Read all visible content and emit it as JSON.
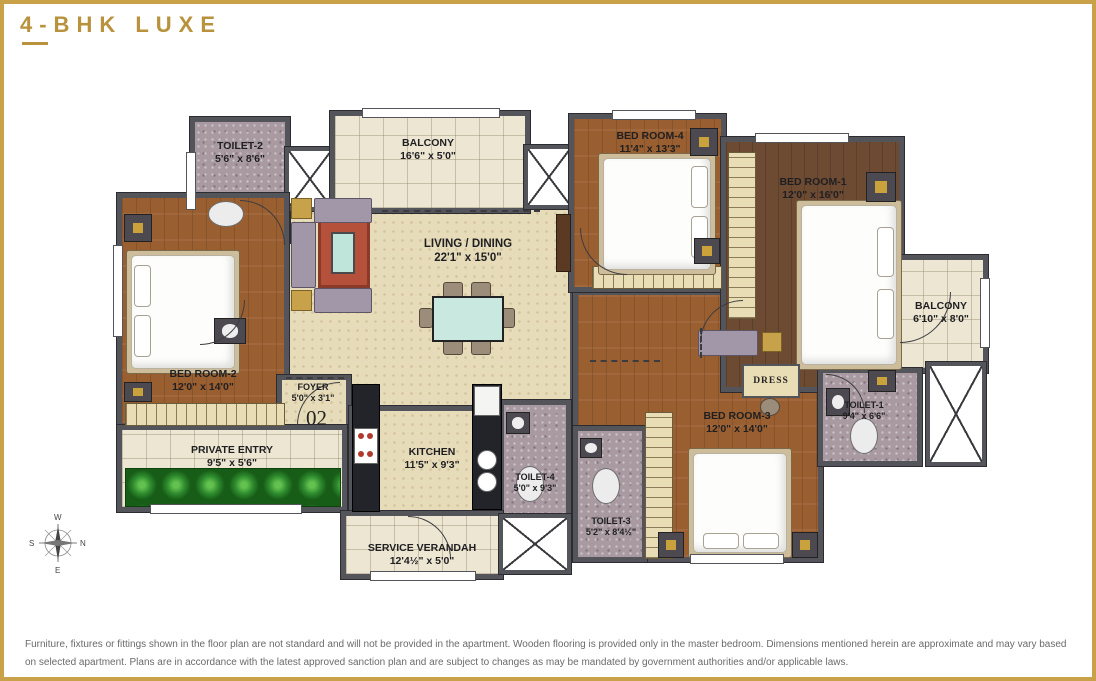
{
  "title": "4-BHK LUXE",
  "unit_number": "02",
  "rooms": {
    "toilet2": {
      "name": "TOILET-2",
      "dim": "5'6\" x 8'6\""
    },
    "balcony_top": {
      "name": "BALCONY",
      "dim": "16'6\" x 5'0\""
    },
    "bedroom4": {
      "name": "BED ROOM-4",
      "dim": "11'4\" x 13'3\""
    },
    "bedroom1": {
      "name": "BED ROOM-1",
      "dim": "12'0\" x 16'0\""
    },
    "balcony_right": {
      "name": "BALCONY",
      "dim": "6'10\" x 8'0\""
    },
    "living": {
      "name": "LIVING / DINING",
      "dim": "22'1\" x 15'0\""
    },
    "bedroom2": {
      "name": "BED ROOM-2",
      "dim": "12'0\" x 14'0\""
    },
    "foyer": {
      "name": "FOYER",
      "dim": "5'0\" x 3'1\""
    },
    "private_entry": {
      "name": "PRIVATE ENTRY",
      "dim": "9'5\" x 5'6\""
    },
    "kitchen": {
      "name": "KITCHEN",
      "dim": "11'5\" x 9'3\""
    },
    "toilet4": {
      "name": "TOILET-4",
      "dim": "5'0\" x 9'3\""
    },
    "service_verandah": {
      "name": "SERVICE VERANDAH",
      "dim": "12'4½\" x 5'0\""
    },
    "toilet3": {
      "name": "TOILET-3",
      "dim": "5'2\" x 8'4½\""
    },
    "bedroom3": {
      "name": "BED ROOM-3",
      "dim": "12'0\" x 14'0\""
    },
    "toilet1": {
      "name": "TOILET-1",
      "dim": "9'4\" x 6'6\""
    },
    "dress": {
      "name": "DRESS",
      "dim": ""
    }
  },
  "compass": {
    "top": "W",
    "right": "N",
    "bottom": "E",
    "left": "S"
  },
  "colors": {
    "accent_gold": "#c9a149",
    "wall": "#54555a",
    "wood": "#9a5f30",
    "wood_master": "#6d4a32",
    "marble": "#e7dcba",
    "balcony_tile": "#ece6d3",
    "toilet_floor": "#a89aa0",
    "counter_black": "#23232a",
    "table_teal": "#c8e8e0",
    "rug_red": "#b5503a",
    "plants_green": "#2e8b2e"
  },
  "disclaimer": "Furniture, fixtures or fittings shown in the floor plan are not standard and will not be provided in the apartment. Wooden flooring is provided only in the master bedroom. Dimensions mentioned herein are approximate and may vary based on selected apartment. Plans are in accordance with the latest approved sanction plan and are subject to changes as may be mandated by government authorities and/or applicable laws."
}
